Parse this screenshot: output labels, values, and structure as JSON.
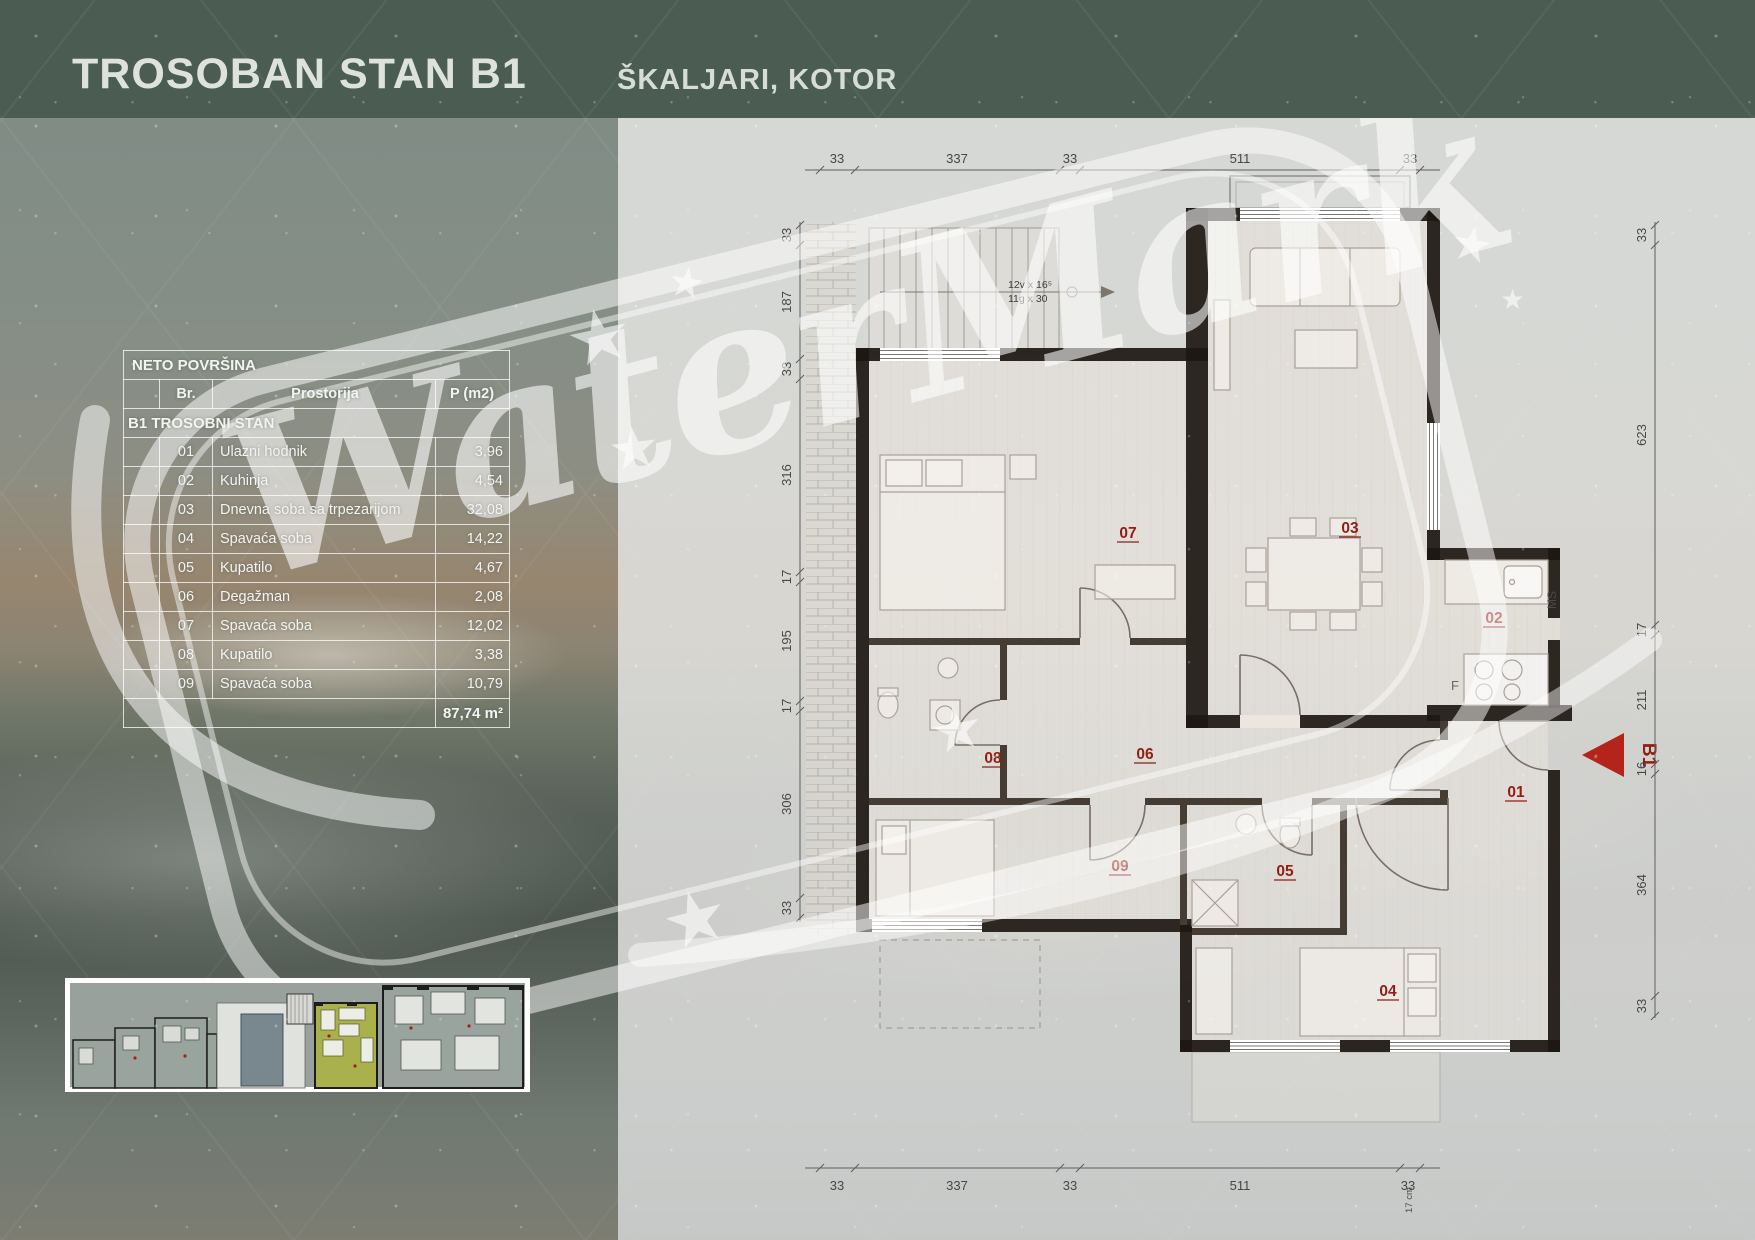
{
  "header": {
    "title": "TROSOBAN STAN B1",
    "location": "ŠKALJARI, KOTOR"
  },
  "area_table": {
    "title": "NETO POVRŠINA",
    "col_br": "Br.",
    "col_room": "Prostorija",
    "col_area": "P (m2)",
    "section": "B1 TROSOBNI STAN",
    "rows": [
      {
        "br": "01",
        "room": "Ulazni hodnik",
        "area": "3,96"
      },
      {
        "br": "02",
        "room": "Kuhinja",
        "area": "4,54"
      },
      {
        "br": "03",
        "room": "Dnevna soba sa trpezarijom",
        "area": "32,08"
      },
      {
        "br": "04",
        "room": "Spavaća soba",
        "area": "14,22"
      },
      {
        "br": "05",
        "room": "Kupatilo",
        "area": "4,67"
      },
      {
        "br": "06",
        "room": "Degažman",
        "area": "2,08"
      },
      {
        "br": "07",
        "room": "Spavaća soba",
        "area": "12,02"
      },
      {
        "br": "08",
        "room": "Kupatilo",
        "area": "3,38"
      },
      {
        "br": "09",
        "room": "Spavaća soba",
        "area": "10,79"
      }
    ],
    "total": "87,74 m²"
  },
  "floor_plan": {
    "room_labels": [
      "01",
      "02",
      "03",
      "04",
      "05",
      "06",
      "07",
      "08",
      "09"
    ],
    "unit_label": "B1",
    "shaft_label": "MS",
    "fridge_label": "F",
    "stair_note_line1": "12v x 16⁵",
    "stair_note_line2": "11g x 30",
    "corner_note": "17 cm",
    "dims": {
      "top": [
        "33",
        "337",
        "33",
        "511",
        "33"
      ],
      "bottom": [
        "33",
        "337",
        "33",
        "511",
        "33"
      ],
      "left": [
        "33",
        "187",
        "33",
        "316",
        "17",
        "195",
        "17",
        "306",
        "33"
      ],
      "right": [
        "33",
        "623",
        "17",
        "211",
        "16",
        "364",
        "33"
      ]
    }
  },
  "watermark": {
    "text": "WaterMark"
  },
  "colors": {
    "header_bg": "#4b5d53",
    "room_label_red": "#8e1f14",
    "marker_red": "#b5241a",
    "highlight_olive": "#a2ac46"
  }
}
